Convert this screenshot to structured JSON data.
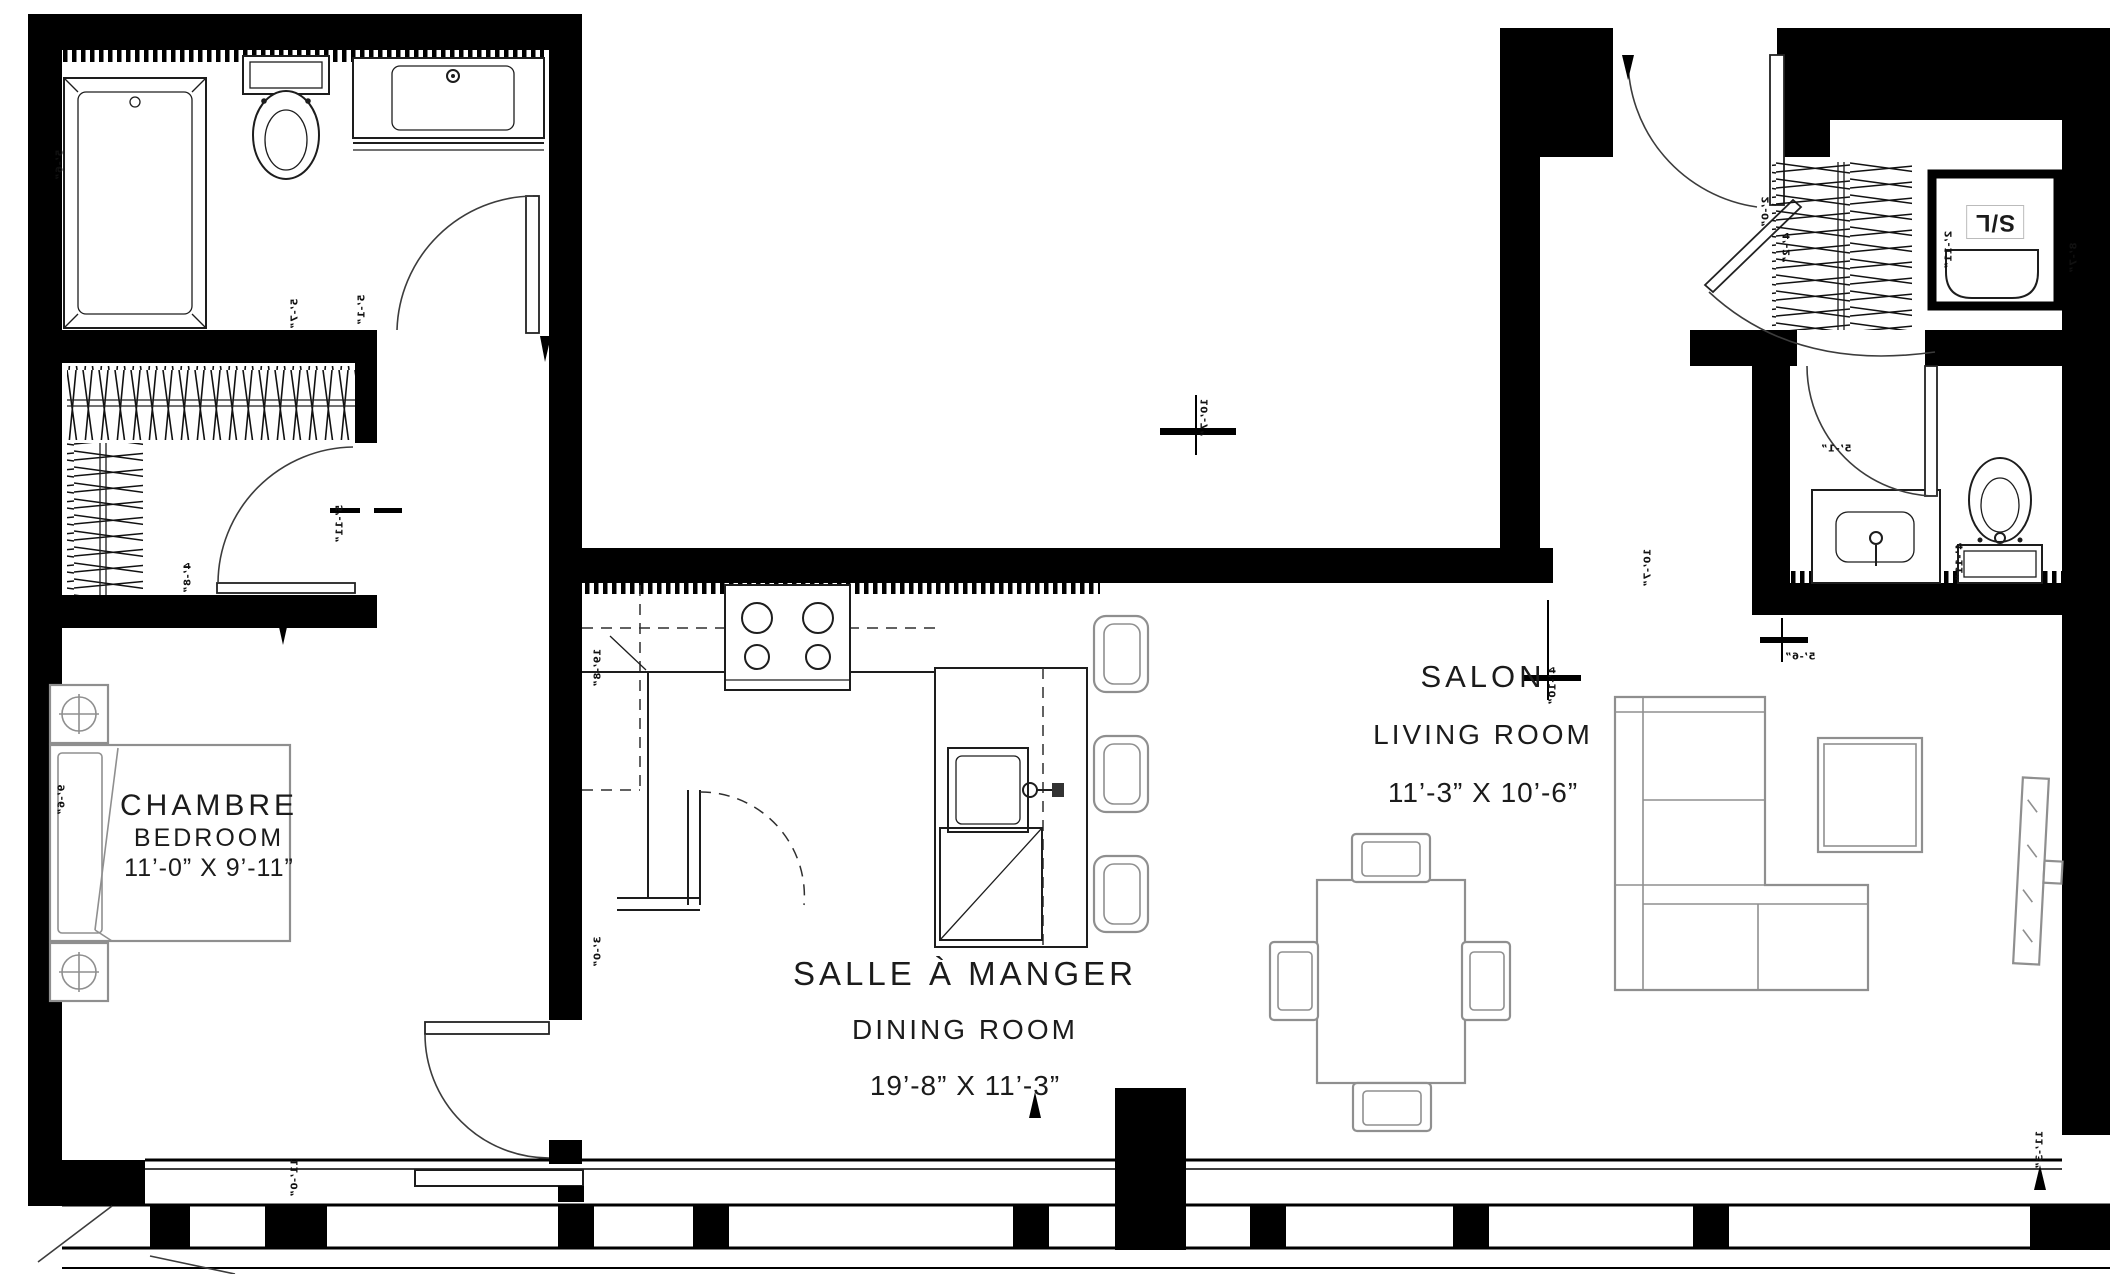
{
  "document": {
    "type": "architectural floor plan",
    "language": "French / English"
  },
  "rooms": {
    "bedroom": {
      "name_fr": "CHAMBRE",
      "name_en": "BEDROOM",
      "dimensions": "11’-0” X 9’-11”"
    },
    "dining": {
      "name_fr": "SALLE À MANGER",
      "name_en": "DINING ROOM",
      "dimensions": "19’-8” X 11’-3”"
    },
    "living": {
      "name_fr": "SALON",
      "name_en": "LIVING ROOM",
      "dimensions": "11’-3” X 10’-6”"
    },
    "laundry": {
      "label": "S/L"
    }
  },
  "dimensions": [
    {
      "x": 60,
      "y": 165,
      "r": -90,
      "m": true,
      "t": "5’-6”"
    },
    {
      "x": 295,
      "y": 314,
      "r": -90,
      "m": true,
      "t": "5’-7”"
    },
    {
      "x": 362,
      "y": 310,
      "r": -90,
      "m": true,
      "t": "5’-1”"
    },
    {
      "x": 340,
      "y": 524,
      "r": -90,
      "m": true,
      "t": "5’-11”"
    },
    {
      "x": 188,
      "y": 578,
      "r": -90,
      "m": true,
      "t": "4’-8”"
    },
    {
      "x": 62,
      "y": 800,
      "r": -90,
      "m": true,
      "t": "9’-6”"
    },
    {
      "x": 295,
      "y": 1178,
      "r": -90,
      "m": true,
      "t": "11’-0”"
    },
    {
      "x": 598,
      "y": 668,
      "r": -90,
      "m": true,
      "t": "19’-8”"
    },
    {
      "x": 598,
      "y": 952,
      "r": -90,
      "m": true,
      "t": "3’-0”"
    },
    {
      "x": 1205,
      "y": 418,
      "r": -90,
      "m": true,
      "t": "10’-7”"
    },
    {
      "x": 1648,
      "y": 568,
      "r": -90,
      "m": true,
      "t": "10’-7”"
    },
    {
      "x": 1553,
      "y": 686,
      "r": -90,
      "m": true,
      "t": "4’-10”"
    },
    {
      "x": 1800,
      "y": 657,
      "r": 0,
      "m": true,
      "t": "5’-6”"
    },
    {
      "x": 1766,
      "y": 212,
      "r": -90,
      "m": true,
      "t": "2’-0”"
    },
    {
      "x": 1787,
      "y": 248,
      "r": -90,
      "m": true,
      "t": "4’-2”"
    },
    {
      "x": 1836,
      "y": 449,
      "r": 0,
      "m": true,
      "t": "5’-1”"
    },
    {
      "x": 1960,
      "y": 562,
      "r": -90,
      "m": true,
      "t": "4’-11”"
    },
    {
      "x": 1949,
      "y": 250,
      "r": -90,
      "m": true,
      "t": "2’-11”"
    },
    {
      "x": 2074,
      "y": 258,
      "r": -90,
      "m": true,
      "t": "8’-7”"
    },
    {
      "x": 2040,
      "y": 1150,
      "r": -90,
      "m": true,
      "t": "11’-3”"
    }
  ],
  "colors": {
    "wall": "#000000",
    "fixture": "#1d1d1d",
    "furniture": "#8f8f8f",
    "accent": "#3c3c3c"
  }
}
